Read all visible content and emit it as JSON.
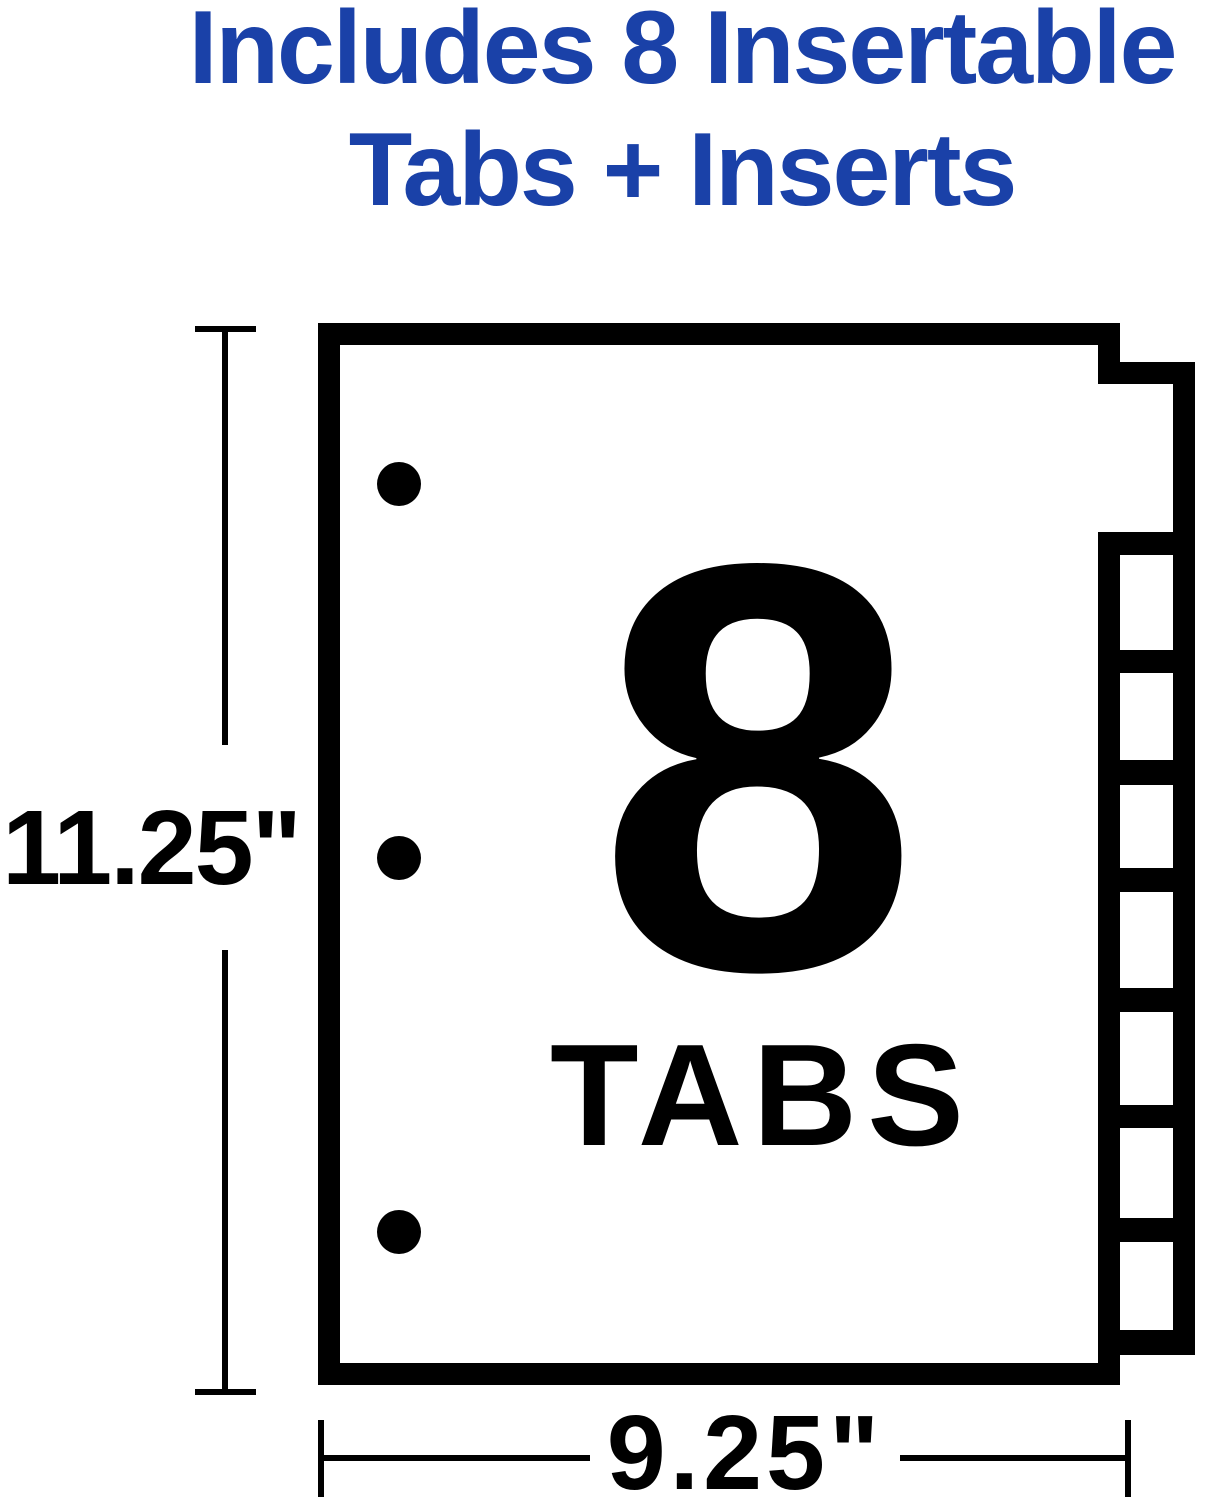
{
  "title": {
    "line1": "Includes 8 Insertable",
    "line2": "Tabs + Inserts",
    "color": "#1A41A8"
  },
  "sheet": {
    "big_count": "8",
    "big_count_caption": "TABS",
    "height_dimension": "11.25\"",
    "width_dimension": "9.25\"",
    "tab_count": 8,
    "hole_count": 3,
    "ink_color": "#000000",
    "paper_color": "#ffffff"
  }
}
